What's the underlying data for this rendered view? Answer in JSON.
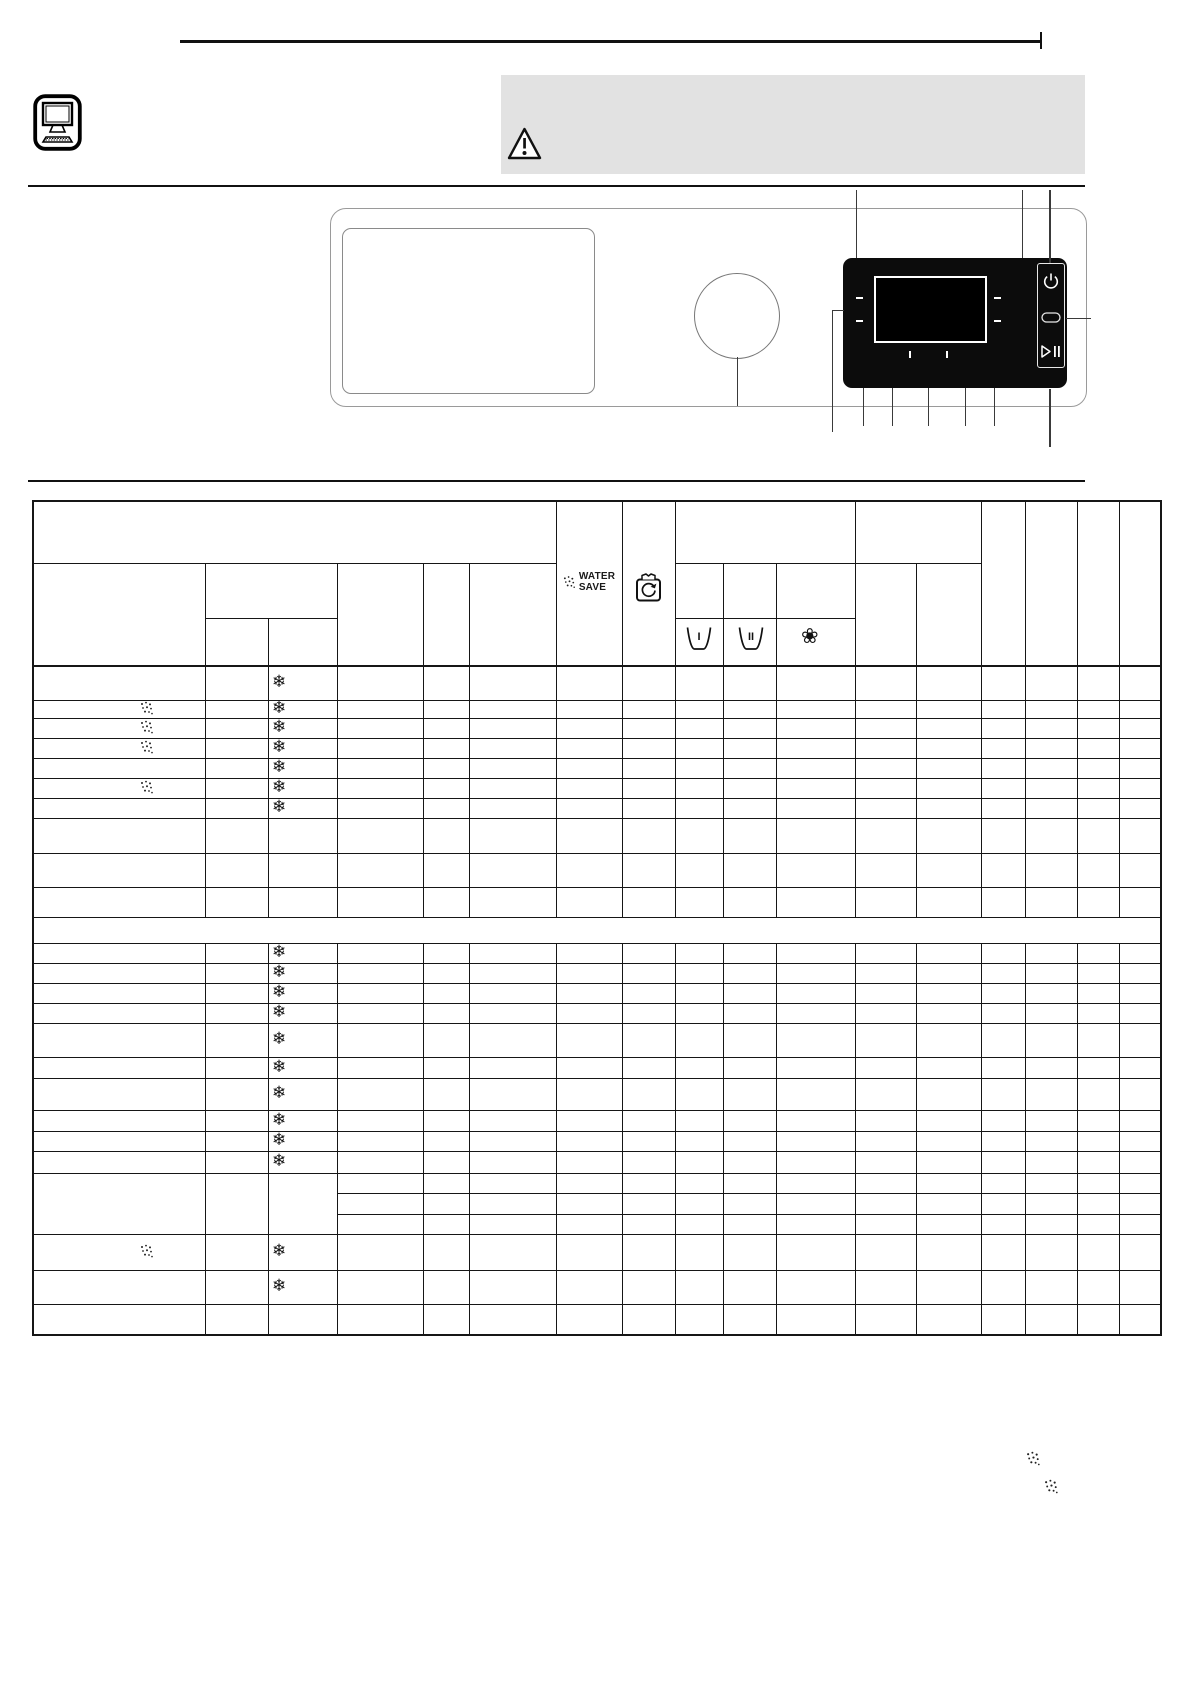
{
  "header_area": {
    "note_icon": "computer-monitor-icon",
    "warning_icon": "warning-triangle-icon",
    "warning_box_color": "#e2e2e2"
  },
  "control_panel_diagram": {
    "parts": [
      "detergent-drawer",
      "program-knob",
      "display",
      "on-off-button",
      "door-button",
      "start-pause-button"
    ],
    "power_button_icon": "power-icon",
    "door_button_icon": "door-pill-icon",
    "start_pause_button_icon": "play-pause-icon",
    "display_tick_count": 4
  },
  "program_table": {
    "water_save": {
      "line1": "WATER",
      "line2": "SAVE",
      "icon": "water-spray-icon"
    },
    "wash_column_icon": "drum-wash-icon",
    "detergent_compartments": {
      "prewash_label": "I",
      "mainwash_label": "II",
      "softener_icon": "flower-icon"
    },
    "snowflake_char": "❄",
    "flower_char": "❀",
    "rows": [
      {
        "h": 35,
        "snow": true
      },
      {
        "h": 18,
        "snow": true,
        "spray": true
      },
      {
        "h": 20,
        "snow": true,
        "spray": true
      },
      {
        "h": 20,
        "snow": true,
        "spray": true
      },
      {
        "h": 20,
        "snow": true
      },
      {
        "h": 20,
        "snow": true,
        "spray": true
      },
      {
        "h": 20,
        "snow": true
      },
      {
        "h": 35
      },
      {
        "h": 34
      },
      {
        "h": 30
      },
      {
        "h": 26,
        "type": "separator"
      },
      {
        "h": 20,
        "snow": true
      },
      {
        "h": 20,
        "snow": true
      },
      {
        "h": 20,
        "snow": true
      },
      {
        "h": 20,
        "snow": true
      },
      {
        "h": 34,
        "snow": true
      },
      {
        "h": 21,
        "snow": true
      },
      {
        "h": 32,
        "snow": true
      },
      {
        "h": 21,
        "snow": true
      },
      {
        "h": 20,
        "snow": true
      },
      {
        "h": 22,
        "snow": true
      },
      {
        "h": 61,
        "type": "multi",
        "subrows": [
          20,
          21,
          20
        ]
      },
      {
        "h": 36,
        "snow": true,
        "spray": true
      },
      {
        "h": 34,
        "snow": true
      },
      {
        "h": 30
      }
    ]
  },
  "footnote_markers": [
    "water-spray-icon",
    "water-spray-icon"
  ]
}
